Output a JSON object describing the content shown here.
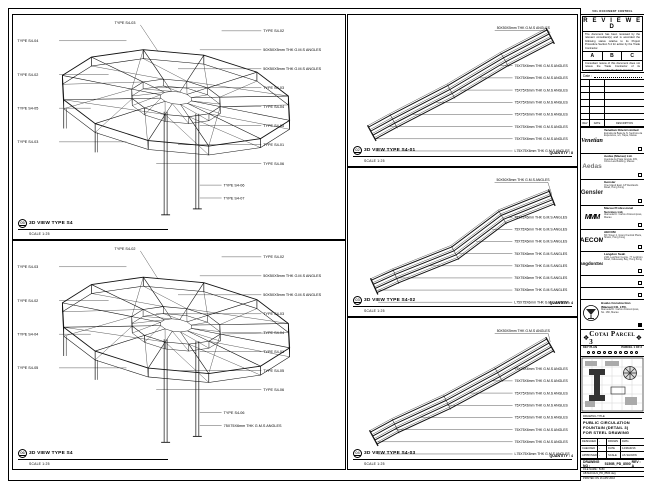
{
  "stamp": {
    "top_note": "VOL DOCUMENT CONTROL",
    "heading": "R E V I E W E D",
    "body1": "The document has been reviewed by the relevant consultant(s) and is accorded the following status relative to its Project Procedure Section 5.4 for action by the Trade Contractor.",
    "grades": [
      "A",
      "B",
      "C"
    ],
    "body2": "Consultant review of this document does not relieve the Trade Contractor of its responsibilities under the Trade Contract.",
    "date_label": "Date :",
    "table_headers": [
      "REV",
      "DATE",
      "DESCRIPTION"
    ]
  },
  "consultants": [
    {
      "logo": "Venetian",
      "name": "Venetian Orient Limited",
      "lines": [
        "Estrada da Baia de N. Senhora da",
        "Esperanca, s/n, Taipa, Macau"
      ]
    },
    {
      "logo": "Aedas",
      "name": "Aedas (Macau) Ltd.",
      "lines": [
        "Avenida da Praia Grande 409,",
        "China Law Building, Macau"
      ]
    },
    {
      "logo": "Gensler",
      "name": "Gensler",
      "lines": [
        "One Island East, 18 Westlands",
        "Road, Hong Kong"
      ]
    },
    {
      "logo": "MMM",
      "name": "Macau Professional Services Ltd.",
      "lines": [
        "Alameda Dr. Carlos d'Assumpcao,",
        "Macau"
      ]
    },
    {
      "logo": "AECOM",
      "name": "AECOM",
      "lines": [
        "8/F Tower 2, Grand Central Plaza,",
        "Shatin, Hong Kong"
      ]
    },
    {
      "logo": "LangdonSeah",
      "name": "Langdon Seah",
      "lines": [
        "2101 Leighton Centre, 77 Leighton",
        "Road, Causeway Bay, Hong Kong"
      ]
    },
    {
      "logo": "",
      "name": "",
      "lines": []
    },
    {
      "logo": "",
      "name": "",
      "lines": []
    }
  ],
  "contractor": {
    "name": "Hsabo Construction (Macau) CO. LTD.",
    "lines": [
      "Alameda Dr. Carlos d'Assumpcao,",
      "No. 180, Macau"
    ]
  },
  "banner": {
    "text": "Cotai Parcel 3",
    "ornament": "❖"
  },
  "keyplan": {
    "label": "KEY PLAN",
    "right": "PARCEL 1 OF 3"
  },
  "titleblock": {
    "label": "DRAWING TITLE",
    "lines": [
      "PUBLIC CIRCULATION",
      "FOUNTAIN (DETAIL 3)",
      "FOR STEEL DRAWING"
    ],
    "rows": [
      {
        "k1": "DESIGNED",
        "v1": "-",
        "k2": "DRAWN",
        "v2": "DWG"
      },
      {
        "k1": "CHECKED",
        "v1": "-",
        "k2": "DATE",
        "v2": "14/MAR/16"
      },
      {
        "k1": "APPROVED",
        "v1": "-",
        "k2": "SCALE",
        "v2": "AS SHOWN"
      }
    ],
    "drawing_no_label": "DRAWING NO :",
    "drawing_no": "5150B_PD_8500",
    "rev": "REV : A",
    "file_rows": [
      "FILE NAME : 5150",
      "AB MACAU1_PD_8500.dwg",
      "PRINTED ON 16 APR 2016"
    ]
  },
  "viewports": {
    "lt": {
      "bubble": "05",
      "title": "3D VIEW TYPE S4",
      "scale": "SCALE 1:25",
      "top_label": "TYPE S4-03",
      "right_labels": [
        "TYPE S4-02",
        "50X50X5mm THK G.M.S ANGLES",
        "50X50X5mm THK G.M.S ANGLES",
        "TYPE S4-03",
        "TYPE S4-04",
        "TYPE S4-05",
        "TYPE S4-01",
        "TYPE S4-06"
      ],
      "left_labels": [
        "TYPE S4-04",
        "TYPE S4-02",
        "TYPE S4-05",
        "TYPE S4-03"
      ],
      "bottom_labels": [
        "TYPE S4-06",
        "TYPE S4-07"
      ]
    },
    "lb": {
      "bubble": "06",
      "title": "3D VIEW TYPE S4",
      "scale": "SCALE 1:25",
      "top_label": "TYPE S4-02",
      "right_labels": [
        "TYPE S4-02",
        "50X50X5mm THK G.M.S ANGLES",
        "50X50X5mm THK G.M.S ANGLES",
        "TYPE S4-03",
        "TYPE S4-04",
        "TYPE S4-01",
        "TYPE S4-05",
        "TYPE S4-06"
      ],
      "left_labels": [
        "TYPE S4-03",
        "TYPE S4-02",
        "TYPE S4-04",
        "TYPE S4-05"
      ],
      "bottom_labels": [
        "TYPE S4-06",
        "75X75X6mm THK G.M.S ANGLES"
      ]
    },
    "m1": {
      "bubble": "02",
      "title": "3D VIEW TYPE S4-01",
      "scale": "SCALE 1:25",
      "quantity": "QUANTITY : 8",
      "top_label": "50X50X5mm THK G.M.S ANGLES",
      "labels": [
        "75X75X6mm THK G.M.S ANGLES",
        "75X75X6mm THK G.M.S ANGLES",
        "75X75X6mm THK G.M.S ANGLES",
        "75X75X6mm THK G.M.S ANGLES",
        "75X75X6mm THK G.M.S ANGLES",
        "75X75X6mm THK G.M.S ANGLES",
        "75X75X6mm THK G.M.S ANGLES",
        "L75X75X6mm THK G.M.S ANGLES"
      ]
    },
    "m2": {
      "bubble": "03",
      "title": "3D VIEW TYPE S4-02",
      "scale": "SCALE 1:25",
      "quantity": "QUANTITY : 4",
      "top_label": "50X50X5mm THK G.M.S ANGLES",
      "labels": [
        "75X75X6mm THK G.M.S ANGLES",
        "75X75X6mm THK G.M.S ANGLES",
        "75X75X6mm THK G.M.S ANGLES",
        "75X75X6mm THK G.M.S ANGLES",
        "75X75X6mm THK G.M.S ANGLES",
        "75X75X6mm THK G.M.S ANGLES",
        "75X75X6mm THK G.M.S ANGLES",
        "L75X75X6mm THK G.M.S ANGLES"
      ]
    },
    "m3": {
      "bubble": "04",
      "title": "3D VIEW TYPE S4-03",
      "scale": "SCALE 1:25",
      "quantity": "QUANTITY : 4",
      "top_label": "50X50X5mm THK G.M.S ANGLES",
      "labels": [
        "75X75X6mm THK G.M.S ANGLES",
        "75X75X6mm THK G.M.S ANGLES",
        "75X75X6mm THK G.M.S ANGLES",
        "75X75X6mm THK G.M.S ANGLES",
        "75X75X6mm THK G.M.S ANGLES",
        "75X75X6mm THK G.M.S ANGLES",
        "75X75X6mm THK G.M.S ANGLES",
        "L75X75X6mm THK G.M.S ANGLES"
      ]
    }
  }
}
